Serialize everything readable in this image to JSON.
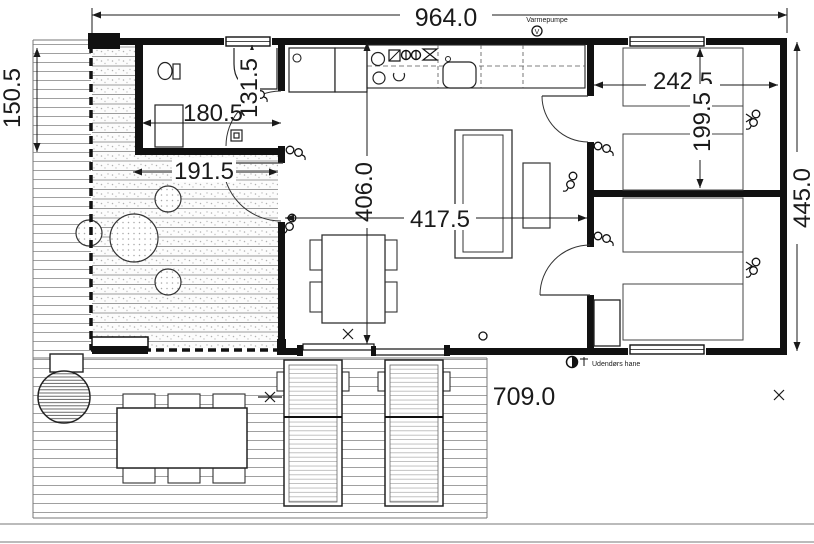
{
  "dimensions": {
    "top_width": "964.0",
    "left_height": "150.5",
    "bathroom_height": "131.5",
    "bathroom_width": "180.5",
    "terrace_width": "191.5",
    "living_height": "406.0",
    "living_width": "417.5",
    "bedroom_width": "242.5",
    "bedroom_height": "199.5",
    "right_height": "445.0",
    "deck_width": "709.0"
  },
  "annotations": {
    "heat_pump_label": "Varmepumpe",
    "heat_pump_symbol": "V",
    "outdoor_tap_label": "Udendørs hane"
  }
}
